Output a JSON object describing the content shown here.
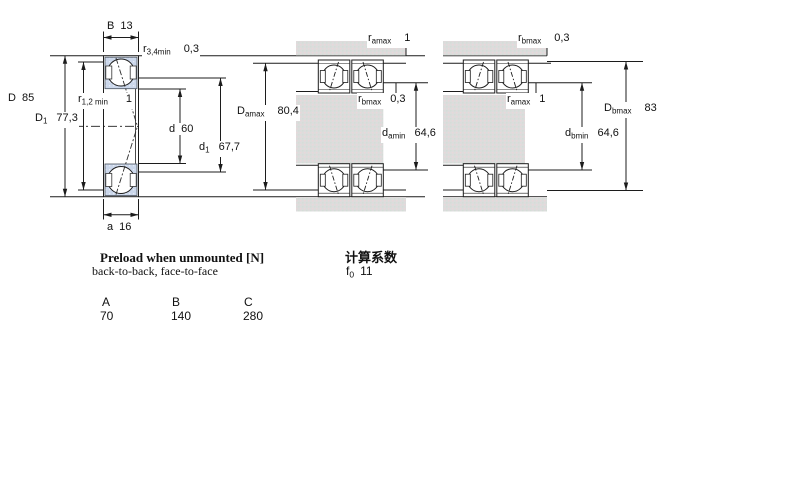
{
  "colors": {
    "line": "#1c1c1c",
    "bearing_section_fill": "#cbd7eb",
    "steel_fill": "#dcdcdc",
    "background": "#ffffff"
  },
  "left_view": {
    "b": {
      "sym": "B",
      "value": "13"
    },
    "r34": {
      "sym": "r",
      "sub": "3,4min",
      "value": "0,3"
    },
    "D": {
      "sym": "D",
      "value": "85"
    },
    "D1": {
      "sym": "D",
      "sub": "1",
      "value": "77,3"
    },
    "r12": {
      "sym": "r",
      "sub": "1,2 min",
      "value": "1"
    },
    "d": {
      "sym": "d",
      "value": "60"
    },
    "d1": {
      "sym": "d",
      "sub": "1",
      "value": "67,7"
    },
    "a": {
      "sym": "a",
      "value": "16"
    }
  },
  "arrangement_a": {
    "r_amax": {
      "sym": "r",
      "sub": "amax",
      "value": "1"
    },
    "r_bmax": {
      "sym": "r",
      "sub": "bmax",
      "value": "0,3"
    },
    "D_amax": {
      "sym": "D",
      "sub": "amax",
      "value": "80,4"
    },
    "d_amin": {
      "sym": "d",
      "sub": "amin",
      "value": "64,6"
    }
  },
  "arrangement_b": {
    "r_bmax": {
      "sym": "r",
      "sub": "bmax",
      "value": "0,3"
    },
    "r_amax": {
      "sym": "r",
      "sub": "amax",
      "value": "1"
    },
    "D_bmax": {
      "sym": "D",
      "sub": "bmax",
      "value": "83"
    },
    "d_bmin": {
      "sym": "d",
      "sub": "bmin",
      "value": "64,6"
    }
  },
  "preload": {
    "title": "Preload when unmounted [N]",
    "subtitle": "back-to-back, face-to-face",
    "columns": [
      "A",
      "B",
      "C"
    ],
    "values": [
      "70",
      "140",
      "280"
    ]
  },
  "calculation": {
    "title": "计算系数",
    "factor": {
      "sym": "f",
      "sub": "0",
      "value": "11"
    }
  }
}
